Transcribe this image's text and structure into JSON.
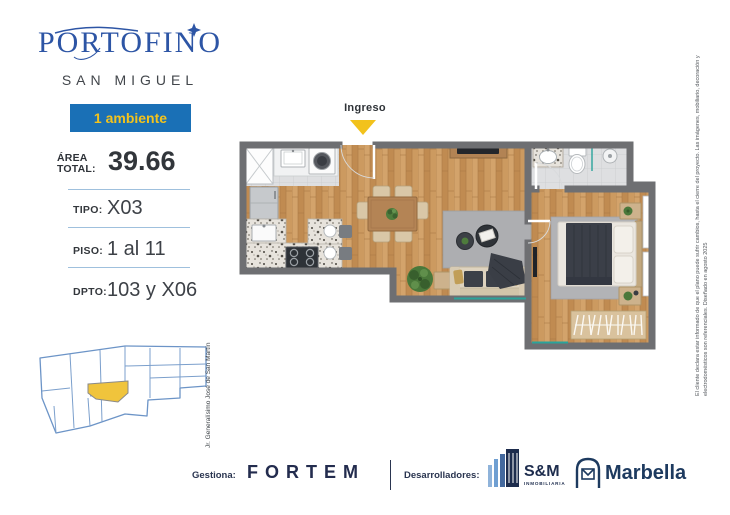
{
  "header": {
    "brand": "PORTOFINO",
    "subtitle": "SAN MIGUEL",
    "badge": "1 ambiente"
  },
  "specs": {
    "area_label": "ÁREA TOTAL:",
    "area_value": "39.66",
    "rows": [
      {
        "label": "TIPO:",
        "value": "X03"
      },
      {
        "label": "PISO:",
        "value": "1 al 11"
      },
      {
        "label": "DPTO:",
        "value": "103 y X06"
      }
    ]
  },
  "map": {
    "street_label": "Jr. Generalísimo José de San Martín"
  },
  "floorplan": {
    "entry_label": "Ingreso"
  },
  "footer": {
    "gestiona_label": "Gestiona:",
    "gestiona_brand": "FORTEM",
    "desarrolladores_label": "Desarrolladores:",
    "developer_sm": "S&M",
    "developer_sm_sub": "INMOBILIARIA",
    "developer_marbella": "Marbella"
  },
  "disclaimer": "El cliente declara estar informado de que el plano puede sufrir cambios, hasta el cierre del proyecto. Las imágenes, mobiliario, decoración y electrodomésticos son referenciales. Diseñado en agosto 2025",
  "colors": {
    "brand_blue": "#2d55a5",
    "badge_bg": "#1a70b6",
    "badge_text": "#f3c31d",
    "accent_yellow": "#f2c21c",
    "navy": "#232c4e",
    "wall_gray": "#6e6f72",
    "teal": "#2aa39b",
    "lot_highlight": "#f0c43c",
    "map_line_blue": "#6c94c7"
  }
}
